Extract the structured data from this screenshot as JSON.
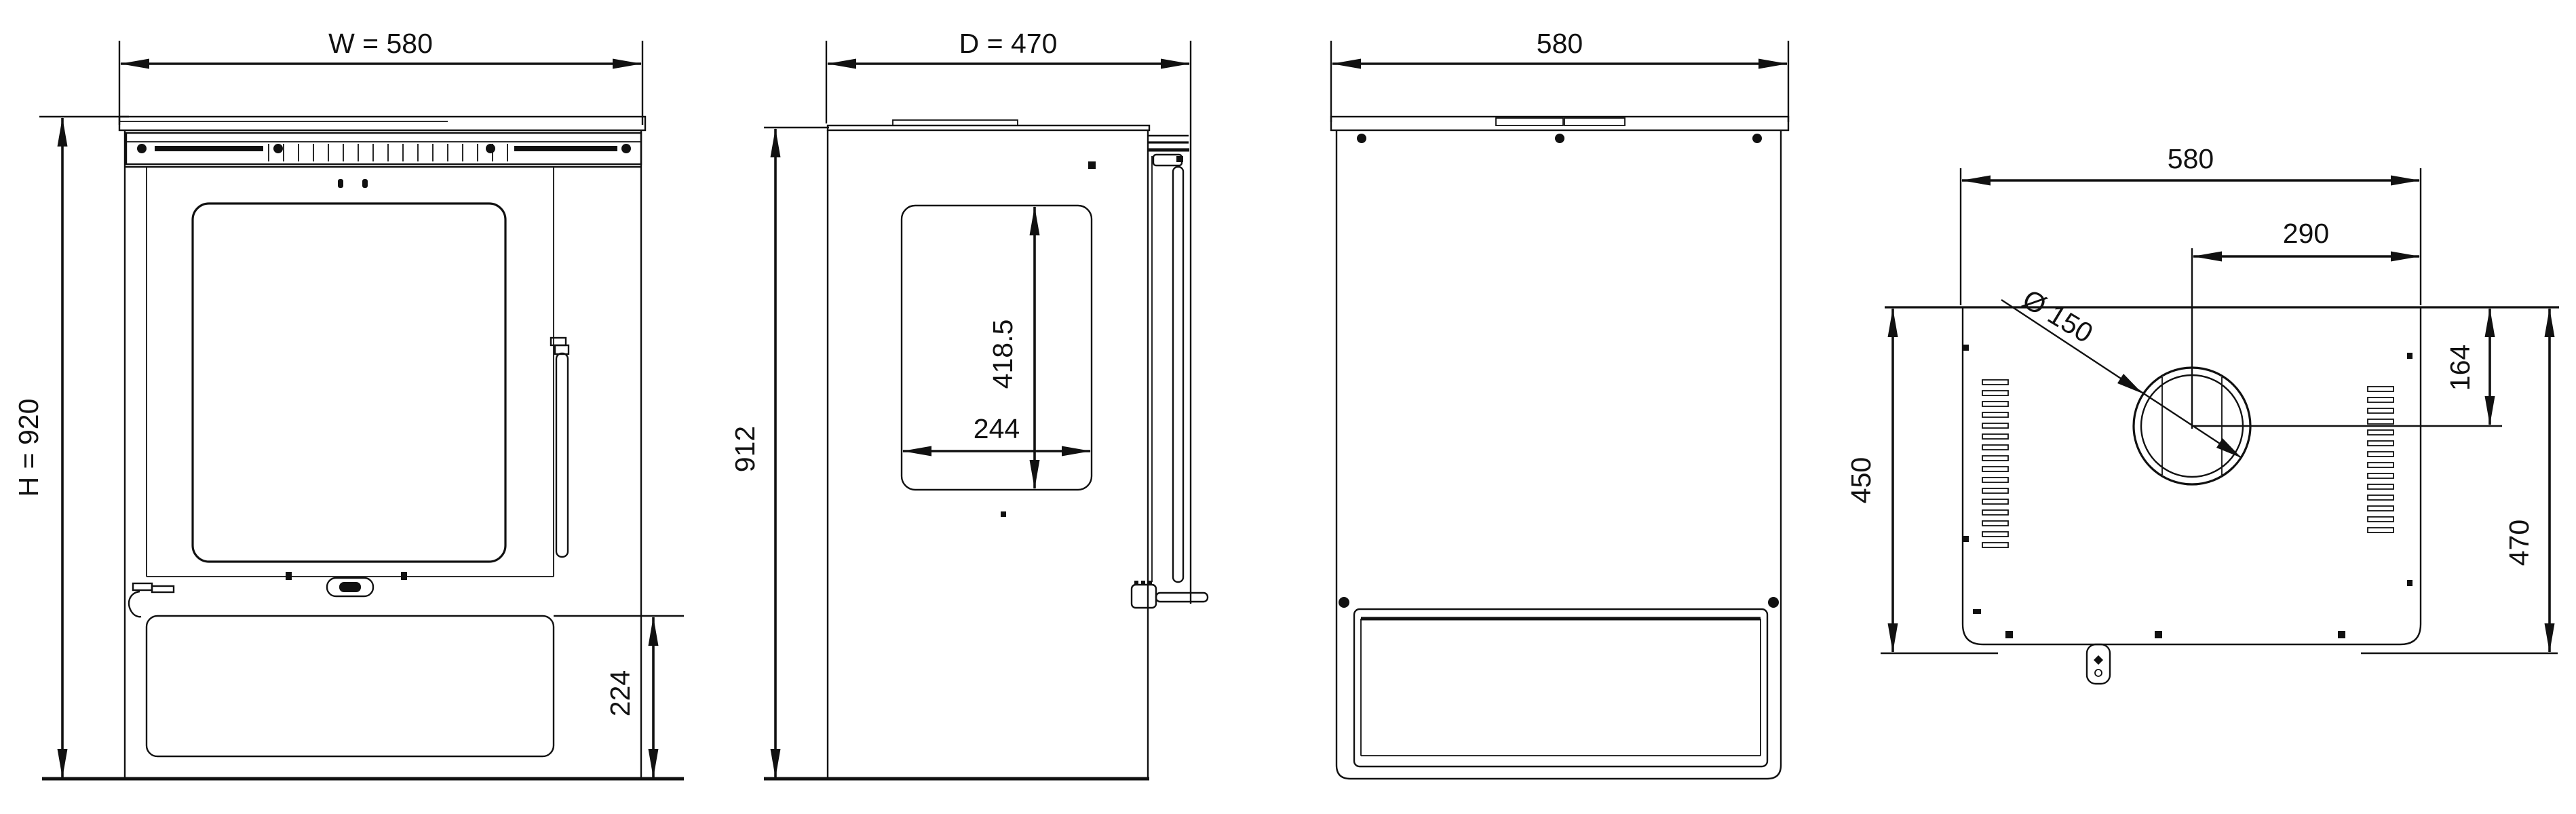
{
  "drawing_title": "Stove dimension drawing - four orthographic views",
  "front_view": {
    "width_label": "W = 580",
    "height_label": "H = 920",
    "base_height_label": "224"
  },
  "side_view": {
    "depth_label": "D = 470",
    "height_label": "912",
    "window_height_label": "418.5",
    "window_width_label": "244"
  },
  "back_view": {
    "width_label": "580"
  },
  "top_view": {
    "width_label": "580",
    "flue_offset_from_right_label": "290",
    "flue_offset_from_rear_label": "164",
    "body_depth_label": "450",
    "overall_depth_label": "470",
    "flue_diameter_label": "Ø 150"
  },
  "colors": {
    "line": "#111111",
    "background": "#ffffff"
  }
}
